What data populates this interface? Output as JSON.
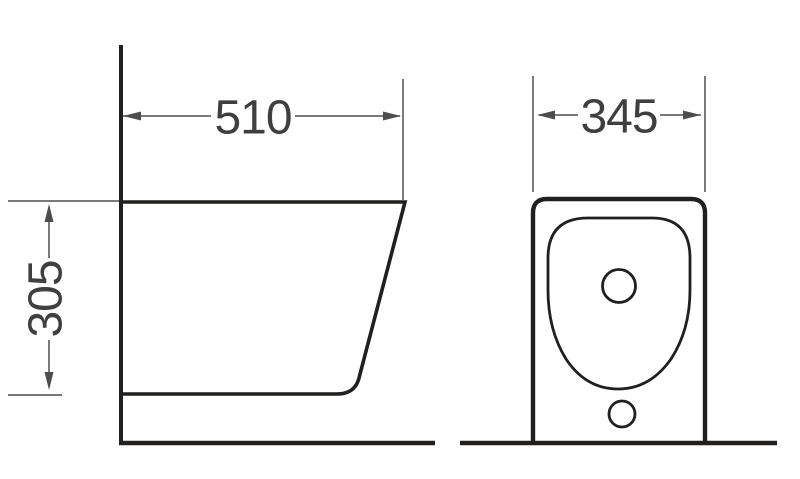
{
  "drawing": {
    "kind": "sanitary-ware dimensioned technical drawing",
    "views": {
      "side": "side view",
      "front": "front view"
    },
    "dimensions": {
      "depth_label": "510",
      "height_label": "305",
      "width_label": "345"
    },
    "colors": {
      "background": "#ffffff",
      "outline": "#221f1f",
      "dimension": "#4d4d4d",
      "label": "#3f3f3f"
    }
  }
}
